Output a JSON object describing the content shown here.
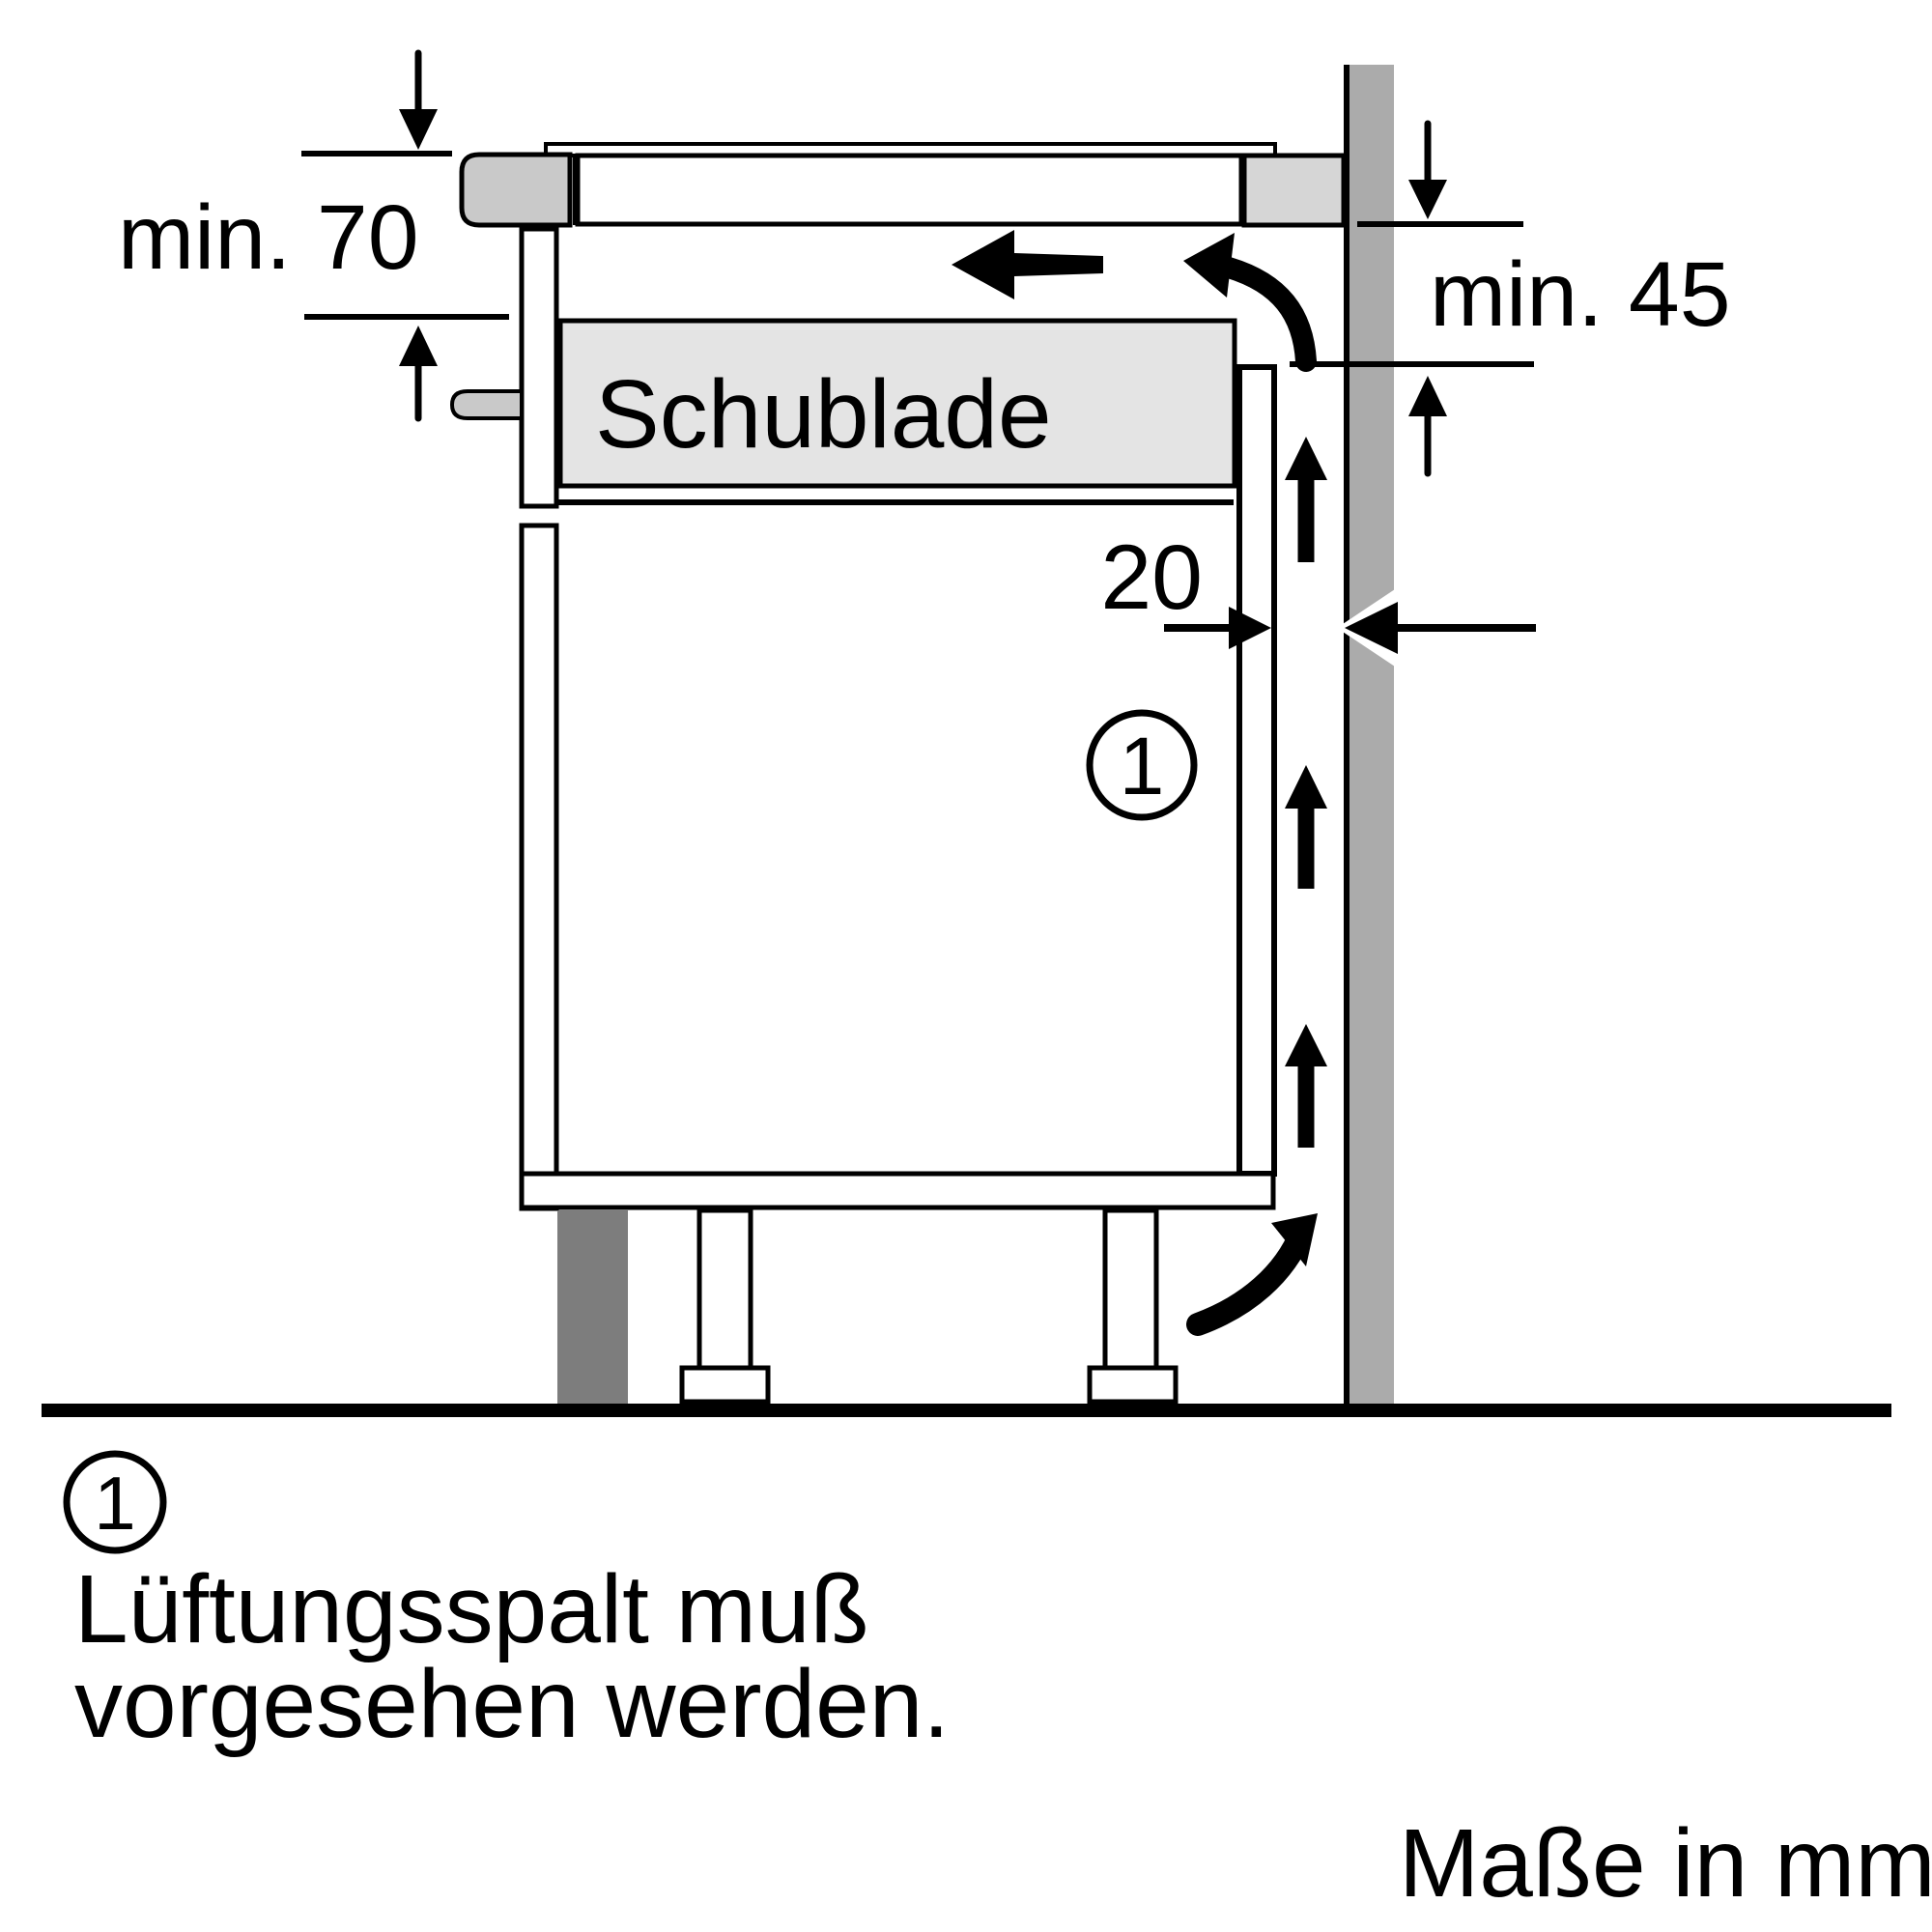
{
  "diagram": {
    "type": "appliance-installation-side-section",
    "labels": {
      "min_clearance_top": "min. 70",
      "min_clearance_side": "min. 45",
      "vent_gap_mm": "20",
      "drawer": "Schublade",
      "callout": "1",
      "note_callout": "1",
      "note_line1": "Lüftungsspalt muß",
      "note_line2": "vorgesehen werden.",
      "units": "Maße in mm"
    },
    "colors": {
      "background": "#ffffff",
      "line": "#000000",
      "wall": "#ababab",
      "worktop_edge": "#c9c9c9",
      "worktop_right": "#d6d6d6",
      "drawer_fill": "#e4e4e4",
      "handle": "#c9c9c9",
      "plinth_foot": "#7d7d7d"
    }
  }
}
